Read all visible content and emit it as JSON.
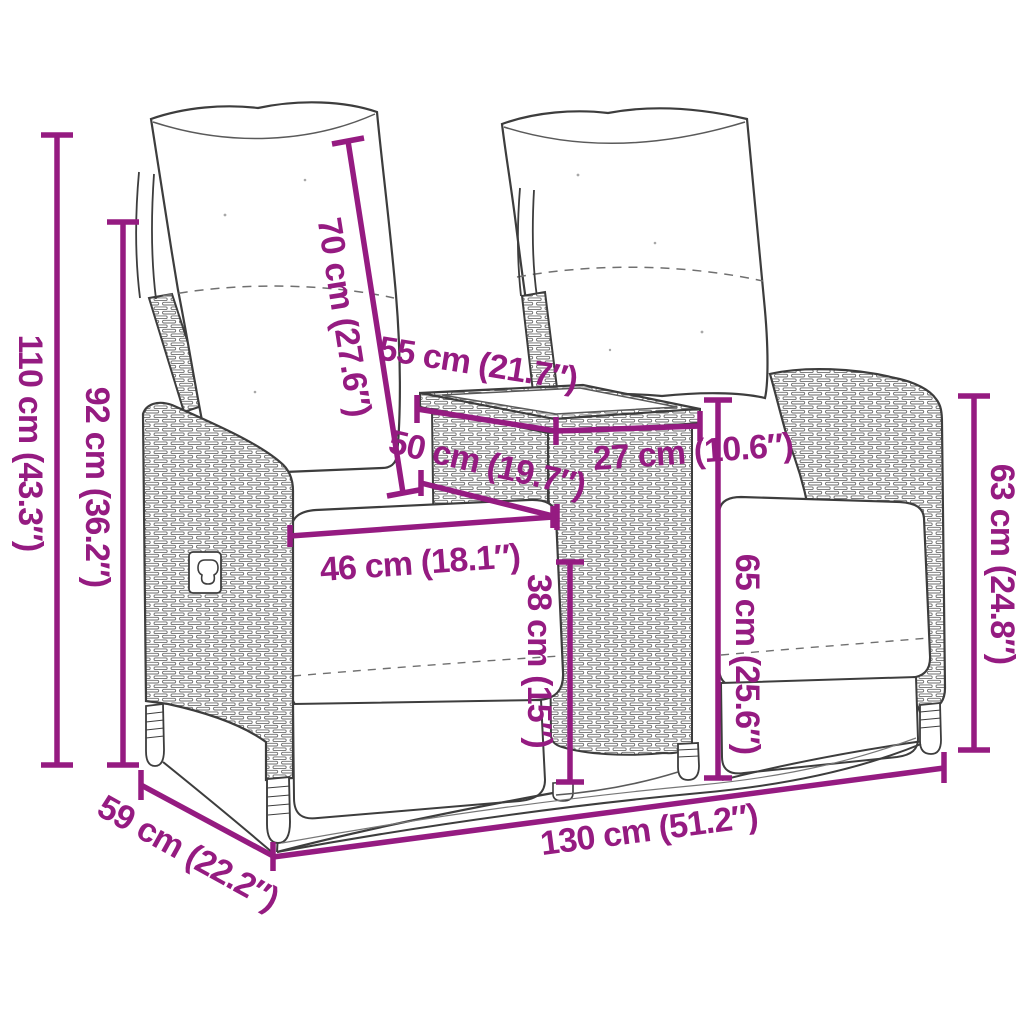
{
  "figure": {
    "type": "product-dimension-diagram",
    "subject": "2-seater reclining garden sofa with centre table and cushions",
    "background_color": "#ffffff",
    "accent_color": "#951B81",
    "art_line_color": "#3d3d3d",
    "units": [
      "cm",
      "inches"
    ]
  },
  "dimensions": [
    {
      "id": "dim-110",
      "cm": 110,
      "inches": 43.3,
      "label": "110 cm (43.3″)"
    },
    {
      "id": "dim-92",
      "cm": 92,
      "inches": 36.2,
      "label": "92 cm (36.2″)"
    },
    {
      "id": "dim-70",
      "cm": 70,
      "inches": 27.6,
      "label": "70 cm (27.6″)"
    },
    {
      "id": "dim-55",
      "cm": 55,
      "inches": 21.7,
      "label": "55 cm (21.7″)"
    },
    {
      "id": "dim-27",
      "cm": 27,
      "inches": 10.6,
      "label": "27 cm (10.6″)"
    },
    {
      "id": "dim-50",
      "cm": 50,
      "inches": 19.7,
      "label": "50 cm (19.7″)"
    },
    {
      "id": "dim-46",
      "cm": 46,
      "inches": 18.1,
      "label": "46 cm (18.1″)"
    },
    {
      "id": "dim-38",
      "cm": 38,
      "inches": 15,
      "label": "38 cm (15″)"
    },
    {
      "id": "dim-65",
      "cm": 65,
      "inches": 25.6,
      "label": "65 cm (25.6″)"
    },
    {
      "id": "dim-63",
      "cm": 63,
      "inches": 24.8,
      "label": "63 cm (24.8″)"
    },
    {
      "id": "dim-130",
      "cm": 130,
      "inches": 51.2,
      "label": "130 cm (51.2″)"
    },
    {
      "id": "dim-59",
      "cm": 59,
      "inches": 22.2,
      "label": "59 cm (22.2″)"
    }
  ]
}
